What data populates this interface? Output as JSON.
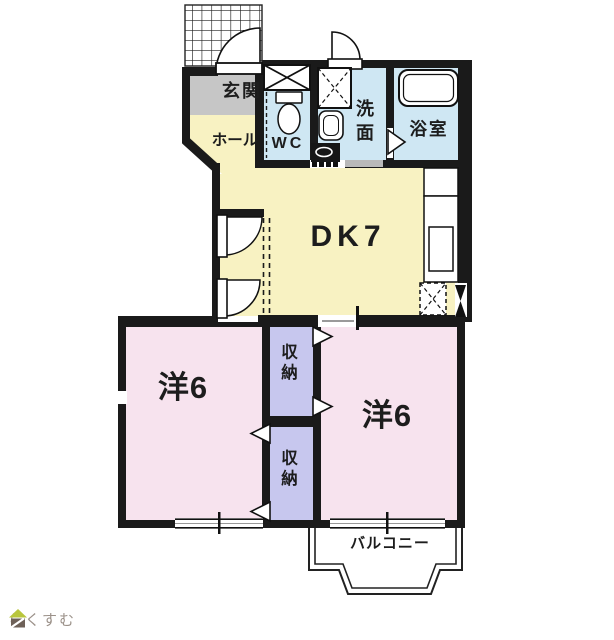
{
  "rooms": {
    "genkan": {
      "label": "玄関"
    },
    "hall": {
      "label": "ホール"
    },
    "wc": {
      "label": "WC"
    },
    "senmen": {
      "label": "洗面"
    },
    "bathroom": {
      "label": "浴室"
    },
    "dk": {
      "label": "DK7"
    },
    "bedroom_left": {
      "label": "洋6"
    },
    "bedroom_right": {
      "label": "洋6"
    },
    "closet_upper": {
      "label": "収納"
    },
    "closet_lower": {
      "label": "収納"
    },
    "balcony": {
      "label": "バルコニー"
    }
  },
  "logo": {
    "text": "らくすむ"
  },
  "colors": {
    "wall": "#1a1a1a",
    "genkan_floor": "#c6c6c6",
    "dk_floor": "#f8f2c2",
    "wet_floor": "#cfe7f3",
    "bedroom_floor": "#f7e3ee",
    "closet_floor": "#c7c7ee",
    "fixture": "#ffffff",
    "logo_roof": "#b9c63d",
    "logo_body": "#6e6158",
    "logo_text": "#9b9189"
  }
}
